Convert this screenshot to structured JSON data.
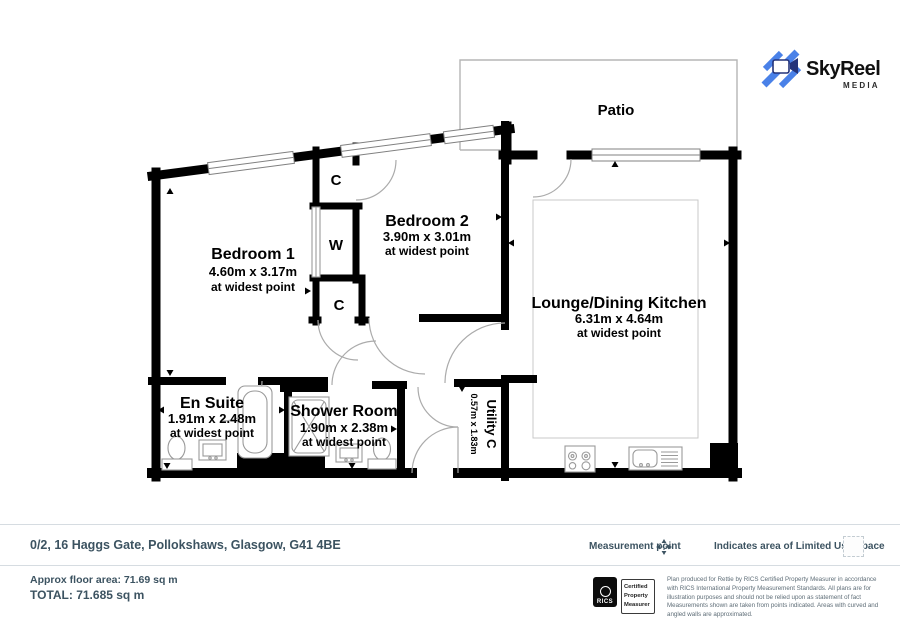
{
  "logo": {
    "brand": "SkyReel",
    "sub": "MEDIA"
  },
  "plan": {
    "patio": "Patio",
    "rooms": [
      {
        "name": "Bedroom 1",
        "dims": "4.60m x 3.17m",
        "note": "at widest point"
      },
      {
        "name": "Bedroom 2",
        "dims": "3.90m x 3.01m",
        "note": "at widest point"
      },
      {
        "name": "Lounge/Dining Kitchen",
        "dims": "6.31m x 4.64m",
        "note": "at widest point"
      },
      {
        "name": "En Suite",
        "dims": "1.91m x 2.48m",
        "note": "at widest point"
      },
      {
        "name": "Shower Room",
        "dims": "1.90m x 2.38m",
        "note": "at widest point"
      },
      {
        "name": "Utility C",
        "dims": "0.57m x 1.83m"
      }
    ],
    "closets": {
      "top": "C",
      "mid": "W",
      "low": "C"
    }
  },
  "footer": {
    "address": "0/2, 16 Haggs Gate, Pollokshaws, Glasgow, G41 4BE",
    "measurement_label": "Measurement point",
    "limited_use_label": "Indicates area of Limited Use Space",
    "approx_area": "Approx floor area: 71.69 sq m",
    "total": "TOTAL: 71.685 sq m",
    "rics": {
      "brand": "RICS",
      "cert_lines": [
        "Certified",
        "Property",
        "Measurer"
      ]
    },
    "disclaimer": "Plan produced for Rettie by RICS Certified Property Measurer in accordance with RICS International Property Measurement Standards.  All plans are for illustration purposes and should not be relied upon as statement of fact Measurements shown are taken from points indicated. Areas with curved and angled walls are approximated."
  },
  "colors": {
    "accent": "#4a81e8",
    "wall": "#000000",
    "footer_text": "#3c5361"
  }
}
